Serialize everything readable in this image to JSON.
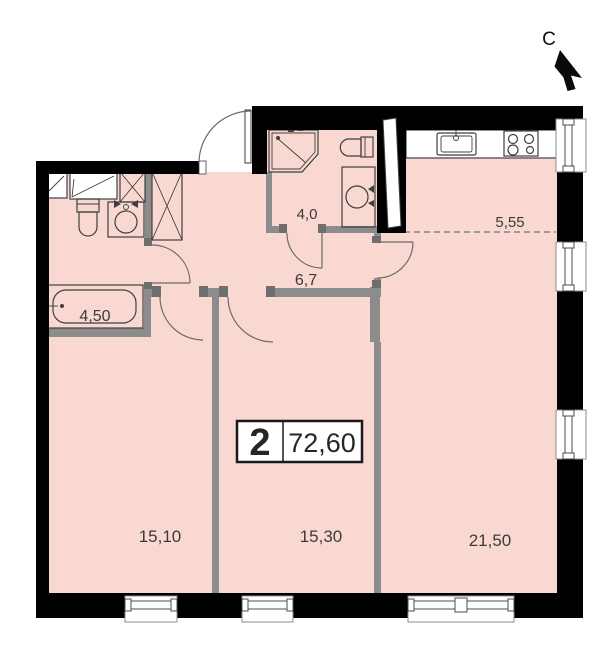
{
  "colors": {
    "room_fill": "#f9d8d2",
    "wall": "#000000",
    "partition": "#8c8c8c",
    "outline": "#3f3f3f",
    "label": "#3a3a3a",
    "door_arc": "#6b6b6b",
    "jamb": "#6e6e6e",
    "window_frame": "#8c8c8c"
  },
  "compass": {
    "north_label": "С"
  },
  "info_badge": {
    "room_count": "2",
    "total_area": "72,60"
  },
  "rooms": {
    "bathroom": {
      "area": "4,50"
    },
    "shower_wc": {
      "area": "4,0"
    },
    "hallway": {
      "area": "6,7"
    },
    "kitchen_niche": {
      "area": "5,55"
    },
    "bedroom_left": {
      "area": "15,10"
    },
    "bedroom_middle": {
      "area": "15,30"
    },
    "living_room": {
      "area": "21,50"
    }
  },
  "fixtures": [
    "bathtub",
    "toilet",
    "washing-machine",
    "ventilation-shaft",
    "shelf",
    "shower-cabin",
    "kitchen-sink",
    "stove",
    "window",
    "door"
  ]
}
